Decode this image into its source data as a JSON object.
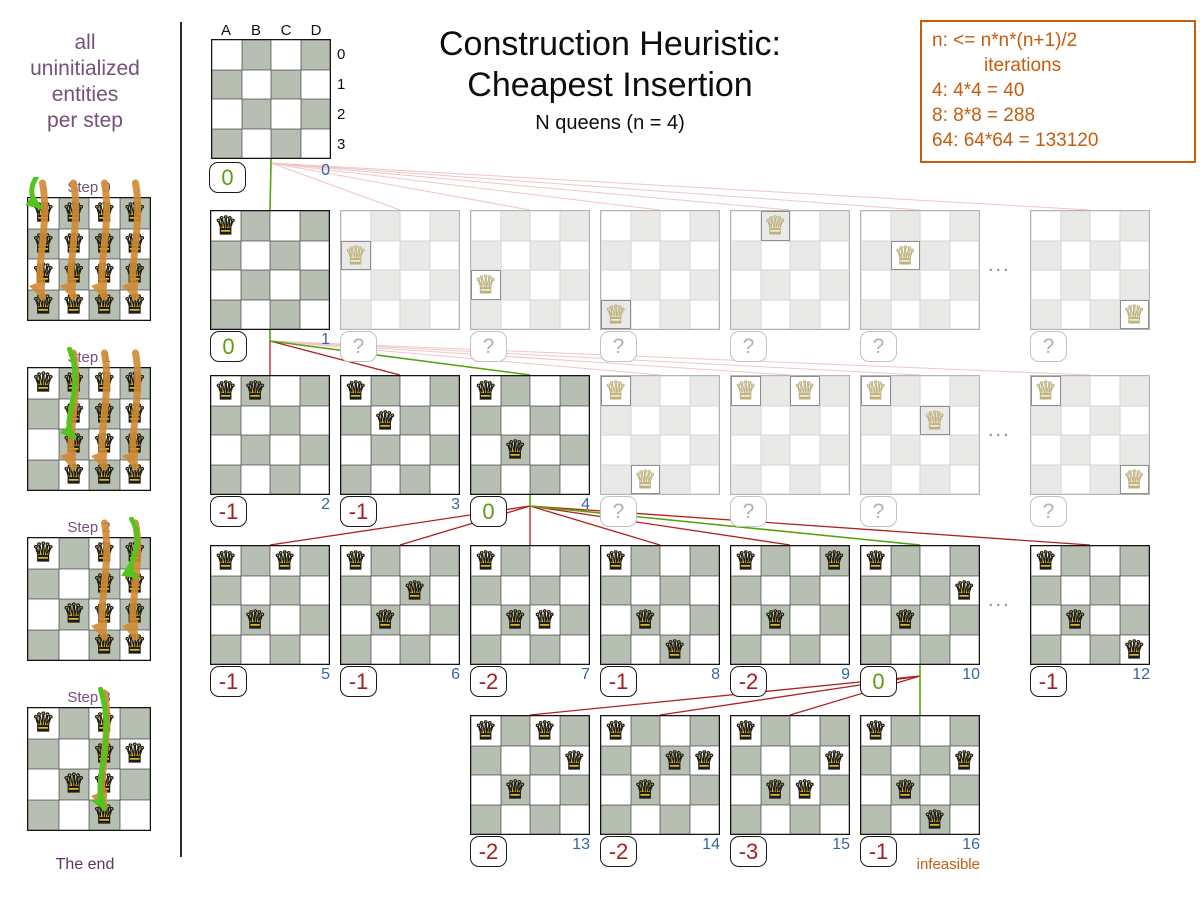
{
  "header": {
    "title_line1": "Construction Heuristic:",
    "title_line2": "Cheapest Insertion",
    "subtitle": "N queens (n = 4)"
  },
  "info_box": {
    "line1": "n: <= n*n*(n+1)/2",
    "line2": "iterations",
    "line3": "4: 4*4 = 40",
    "line4": "8: 8*8 = 288",
    "line5": "64: 64*64 = 133120"
  },
  "left_panel": {
    "caption_lines": [
      "all",
      "uninitialized",
      "entities",
      "per step"
    ],
    "footer": "The end",
    "steps": [
      {
        "label": "Step 0",
        "fixed_queens": [],
        "candidate_columns": [
          0,
          1,
          2,
          3
        ],
        "chosen_cell": {
          "col": 0,
          "row": 0
        }
      },
      {
        "label": "Step 1",
        "fixed_queens": [
          "A0"
        ],
        "candidate_columns": [
          1,
          2,
          3
        ],
        "chosen_cell": {
          "col": 1,
          "row": 2
        }
      },
      {
        "label": "Step 2",
        "fixed_queens": [
          "A0",
          "B2"
        ],
        "candidate_columns": [
          2,
          3
        ],
        "chosen_cell": {
          "col": 3,
          "row": 1
        }
      },
      {
        "label": "Step 3",
        "fixed_queens": [
          "A0",
          "D1",
          "B2"
        ],
        "candidate_columns": [
          2
        ],
        "chosen_cell": {
          "col": 2,
          "row": 3
        }
      }
    ]
  },
  "root_board": {
    "column_headers": [
      "A",
      "B",
      "C",
      "D"
    ],
    "row_headers": [
      "0",
      "1",
      "2",
      "3"
    ],
    "score": "0",
    "index": "0"
  },
  "tree": {
    "ellipsis": "...",
    "rows": [
      {
        "parent": "root",
        "ellipsis": true,
        "boards": [
          {
            "slot": 0,
            "queens": [
              "A0"
            ],
            "score": "0",
            "index": "1",
            "state": "solid",
            "edge": "green"
          },
          {
            "slot": 1,
            "queens": [
              "A1"
            ],
            "score": "?",
            "state": "faded",
            "edge": "pink"
          },
          {
            "slot": 2,
            "queens": [
              "A2"
            ],
            "score": "?",
            "state": "faded",
            "edge": "pink"
          },
          {
            "slot": 3,
            "queens": [
              "A3"
            ],
            "score": "?",
            "state": "faded",
            "edge": "pink"
          },
          {
            "slot": 4,
            "queens": [
              "B0"
            ],
            "score": "?",
            "state": "faded",
            "edge": "pink"
          },
          {
            "slot": 5,
            "queens": [
              "B1"
            ],
            "score": "?",
            "state": "faded",
            "edge": "pink"
          },
          {
            "slot": 6,
            "queens": [
              "D3"
            ],
            "score": "?",
            "state": "faded",
            "edge": "pink"
          }
        ]
      },
      {
        "parent_slot": 0,
        "ellipsis": true,
        "boards": [
          {
            "slot": 0,
            "queens": [
              "A0",
              "B0"
            ],
            "score": "-1",
            "index": "2",
            "state": "solid",
            "edge": "red"
          },
          {
            "slot": 1,
            "queens": [
              "A0",
              "B1"
            ],
            "score": "-1",
            "index": "3",
            "state": "solid",
            "edge": "red"
          },
          {
            "slot": 2,
            "queens": [
              "A0",
              "B2"
            ],
            "score": "0",
            "index": "4",
            "state": "solid",
            "edge": "green"
          },
          {
            "slot": 3,
            "queens": [
              "A0",
              "B3"
            ],
            "score": "?",
            "state": "faded",
            "edge": "pink"
          },
          {
            "slot": 4,
            "queens": [
              "A0",
              "C0"
            ],
            "score": "?",
            "state": "faded",
            "edge": "pink"
          },
          {
            "slot": 5,
            "queens": [
              "A0",
              "C1"
            ],
            "score": "?",
            "state": "faded",
            "edge": "pink"
          },
          {
            "slot": 6,
            "queens": [
              "A0",
              "D3"
            ],
            "score": "?",
            "state": "faded",
            "edge": "pink"
          }
        ]
      },
      {
        "parent_slot": 2,
        "ellipsis": true,
        "boards": [
          {
            "slot": 0,
            "queens": [
              "A0",
              "C0",
              "B2"
            ],
            "score": "-1",
            "index": "5",
            "state": "solid",
            "edge": "red"
          },
          {
            "slot": 1,
            "queens": [
              "A0",
              "C1",
              "B2"
            ],
            "score": "-1",
            "index": "6",
            "state": "solid",
            "edge": "red"
          },
          {
            "slot": 2,
            "queens": [
              "A0",
              "B2",
              "C2"
            ],
            "score": "-2",
            "index": "7",
            "state": "solid",
            "edge": "red"
          },
          {
            "slot": 3,
            "queens": [
              "A0",
              "B2",
              "C3"
            ],
            "score": "-1",
            "index": "8",
            "state": "solid",
            "edge": "red"
          },
          {
            "slot": 4,
            "queens": [
              "A0",
              "D0",
              "B2"
            ],
            "score": "-2",
            "index": "9",
            "state": "solid",
            "edge": "red"
          },
          {
            "slot": 5,
            "queens": [
              "A0",
              "D1",
              "B2"
            ],
            "score": "0",
            "index": "10",
            "state": "solid",
            "edge": "green"
          },
          {
            "slot": 6,
            "queens": [
              "A0",
              "B2",
              "D3"
            ],
            "score": "-1",
            "index": "12",
            "state": "solid",
            "edge": "red"
          }
        ]
      },
      {
        "parent_slot": 5,
        "ellipsis": false,
        "boards": [
          {
            "slot": 2,
            "queens": [
              "A0",
              "C0",
              "D1",
              "B2"
            ],
            "score": "-2",
            "index": "13",
            "state": "solid",
            "edge": "red"
          },
          {
            "slot": 3,
            "queens": [
              "A0",
              "C1",
              "D1",
              "B2"
            ],
            "score": "-2",
            "index": "14",
            "state": "solid",
            "edge": "red"
          },
          {
            "slot": 4,
            "queens": [
              "A0",
              "D1",
              "B2",
              "C2"
            ],
            "score": "-3",
            "index": "15",
            "state": "solid",
            "edge": "red"
          },
          {
            "slot": 5,
            "queens": [
              "A0",
              "D1",
              "B2",
              "C3"
            ],
            "score": "-1",
            "index": "16",
            "state": "solid",
            "edge": "green",
            "note": "infeasible"
          }
        ]
      }
    ]
  },
  "colors": {
    "green": "#5a9e13",
    "red": "#a51d1d",
    "blue": "#3465a4",
    "orange": "#c65c0e",
    "purple": "#75507b",
    "pink_line": "#efc6c6",
    "red_line": "#b12020",
    "green_line": "#56a30c",
    "arrow_orange": "#d08a33",
    "arrow_green": "#54c41d"
  }
}
